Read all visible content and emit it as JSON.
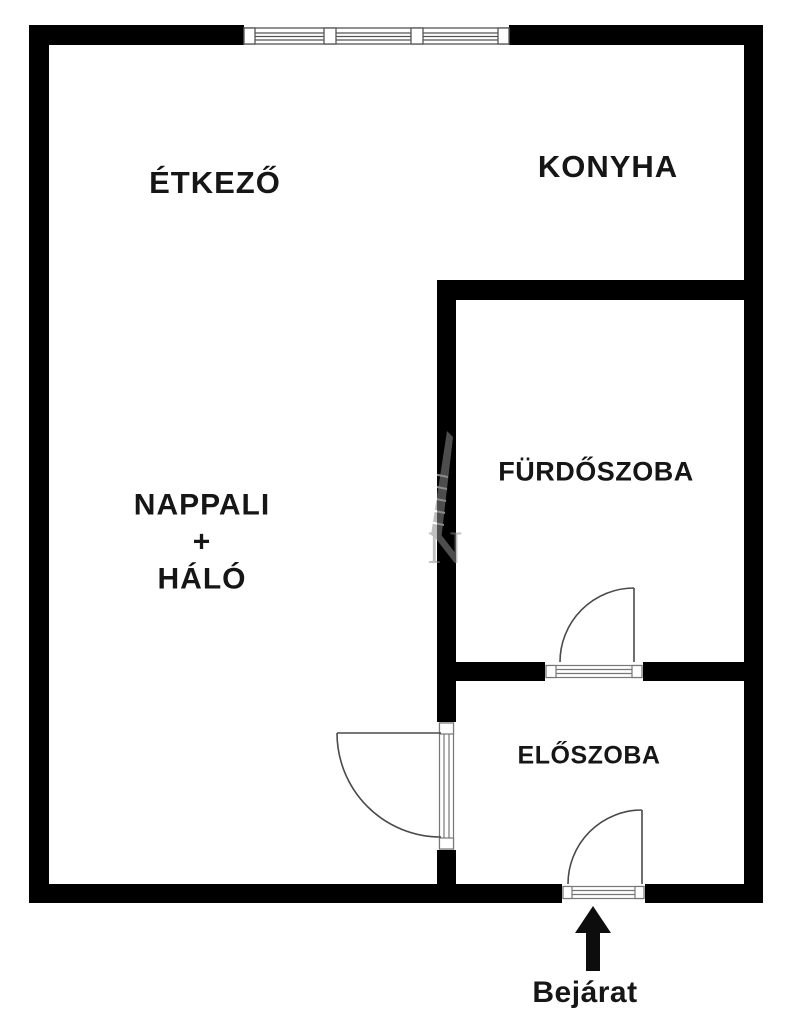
{
  "plan": {
    "rooms": {
      "dining": "ÉTKEZŐ",
      "kitchen": "KONYHA",
      "living_line1": "NAPPALI",
      "living_line2": "+",
      "living_line3": "HÁLÓ",
      "bathroom": "FÜRDŐSZOBA",
      "hallway": "ELŐSZOBA"
    },
    "entrance_label": "Bejárat",
    "watermark_letter": "N",
    "colors": {
      "wall": "#000000",
      "text": "#161616",
      "door_line": "#4a4a4a",
      "sill_line": "#777777",
      "watermark": "#8c8c8c",
      "background": "#ffffff"
    }
  }
}
